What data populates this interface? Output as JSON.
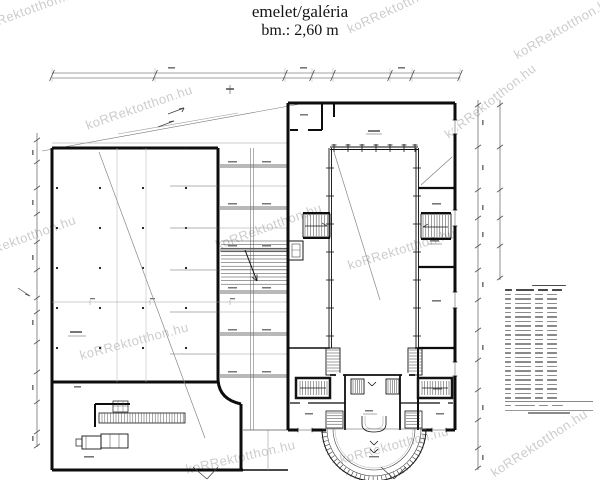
{
  "title": {
    "line1": "emelet/galéria",
    "line2": "bm.: 2,60 m"
  },
  "watermark": {
    "text": "koRRektotthon.hu"
  },
  "colors": {
    "ink": "#141414",
    "wall": "#0d0d0d",
    "thin": "#444444",
    "faint": "#999999",
    "hatch": "#3a3a3a",
    "label_bar": "#777777"
  },
  "schedule": {
    "note": "room list table, text not legible at source resolution",
    "rows": 24,
    "columns": 4
  }
}
